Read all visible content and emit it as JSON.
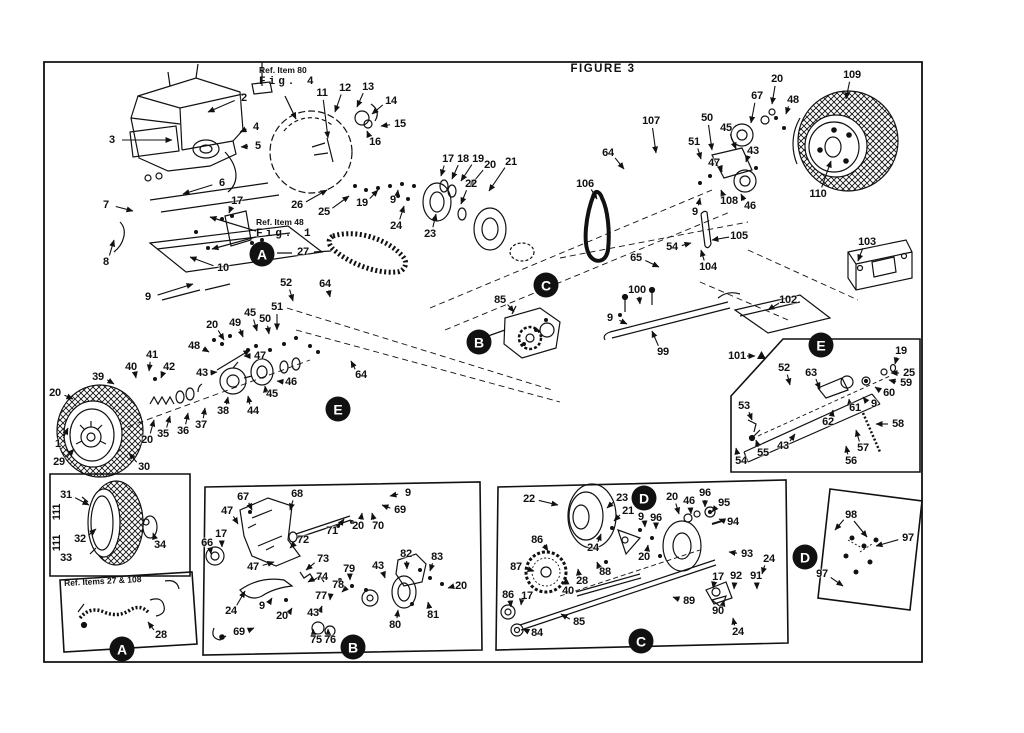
{
  "figure": {
    "title": "FIGURE 3"
  },
  "notes": {
    "top_ref": {
      "line1": "Ref. Item 80",
      "line2": "Fig. 4"
    },
    "mid_ref": {
      "line1": "Ref. Item 48",
      "line2": "Fig. 1"
    },
    "inset_a2_title": "Ref. Items 27 & 108"
  },
  "colors": {
    "ink": "#111111",
    "paper": "#ffffff"
  },
  "callouts": [
    {
      "letter": "A",
      "x": 262,
      "y": 254
    },
    {
      "letter": "A",
      "x": 122,
      "y": 649
    },
    {
      "letter": "B",
      "x": 479,
      "y": 342
    },
    {
      "letter": "B",
      "x": 353,
      "y": 647
    },
    {
      "letter": "C",
      "x": 546,
      "y": 285
    },
    {
      "letter": "C",
      "x": 641,
      "y": 641
    },
    {
      "letter": "D",
      "x": 644,
      "y": 498
    },
    {
      "letter": "D",
      "x": 805,
      "y": 557
    },
    {
      "letter": "E",
      "x": 338,
      "y": 409
    },
    {
      "letter": "E",
      "x": 821,
      "y": 345
    }
  ],
  "part_labels": [
    {
      "t": "2",
      "x": 244,
      "y": 98,
      "tx": 208,
      "ty": 112
    },
    {
      "t": "3",
      "x": 112,
      "y": 140,
      "tx": 172,
      "ty": 140
    },
    {
      "t": "4",
      "x": 256,
      "y": 127,
      "tx": 240,
      "ty": 132
    },
    {
      "t": "5",
      "x": 258,
      "y": 146,
      "tx": 241,
      "ty": 147
    },
    {
      "t": "6",
      "x": 222,
      "y": 183,
      "tx": 183,
      "ty": 194
    },
    {
      "t": "7",
      "x": 106,
      "y": 205,
      "tx": 133,
      "ty": 211
    },
    {
      "t": "8",
      "x": 106,
      "y": 262,
      "tx": 114,
      "ty": 240
    },
    {
      "t": "9",
      "x": 148,
      "y": 297,
      "tx": 193,
      "ty": 284
    },
    {
      "t": "10",
      "x": 223,
      "y": 268,
      "tx": 190,
      "ty": 257
    },
    {
      "t": "17",
      "x": 237,
      "y": 201,
      "tx": 229,
      "ty": 213
    },
    {
      "t": "27",
      "x": 303,
      "y": 252
    },
    {
      "t": "11",
      "x": 322,
      "y": 93,
      "tx": 328,
      "ty": 138
    },
    {
      "t": "12",
      "x": 345,
      "y": 88,
      "tx": 335,
      "ty": 112
    },
    {
      "t": "13",
      "x": 368,
      "y": 87,
      "tx": 357,
      "ty": 107
    },
    {
      "t": "14",
      "x": 391,
      "y": 101,
      "tx": 372,
      "ty": 114
    },
    {
      "t": "15",
      "x": 400,
      "y": 124,
      "tx": 381,
      "ty": 126
    },
    {
      "t": "16",
      "x": 375,
      "y": 142,
      "tx": 367,
      "ty": 131
    },
    {
      "t": "17",
      "x": 448,
      "y": 159,
      "tx": 441,
      "ty": 176
    },
    {
      "t": "18",
      "x": 463,
      "y": 159,
      "tx": 452,
      "ty": 179
    },
    {
      "t": "19",
      "x": 478,
      "y": 159,
      "tx": 461,
      "ty": 181
    },
    {
      "t": "20",
      "x": 490,
      "y": 165,
      "tx": 470,
      "ty": 186
    },
    {
      "t": "21",
      "x": 511,
      "y": 162,
      "tx": 489,
      "ty": 191
    },
    {
      "t": "22",
      "x": 471,
      "y": 184,
      "tx": 461,
      "ty": 204
    },
    {
      "t": "23",
      "x": 430,
      "y": 234,
      "tx": 436,
      "ty": 214
    },
    {
      "t": "24",
      "x": 396,
      "y": 226,
      "tx": 404,
      "ty": 206
    },
    {
      "t": "9",
      "x": 393,
      "y": 200,
      "tx": 398,
      "ty": 190
    },
    {
      "t": "19",
      "x": 362,
      "y": 203,
      "tx": 378,
      "ty": 190
    },
    {
      "t": "25",
      "x": 324,
      "y": 212,
      "tx": 349,
      "ty": 196
    },
    {
      "t": "26",
      "x": 297,
      "y": 205,
      "tx": 327,
      "ty": 190
    },
    {
      "t": "52",
      "x": 286,
      "y": 283,
      "tx": 293,
      "ty": 301
    },
    {
      "t": "64",
      "x": 325,
      "y": 284,
      "tx": 330,
      "ty": 297
    },
    {
      "t": "51",
      "x": 277,
      "y": 307,
      "tx": 277,
      "ty": 330
    },
    {
      "t": "50",
      "x": 265,
      "y": 319,
      "tx": 269,
      "ty": 334
    },
    {
      "t": "45",
      "x": 250,
      "y": 313,
      "tx": 257,
      "ty": 331
    },
    {
      "t": "49",
      "x": 235,
      "y": 323,
      "tx": 243,
      "ty": 337
    },
    {
      "t": "20",
      "x": 212,
      "y": 325,
      "tx": 224,
      "ty": 340
    },
    {
      "t": "48",
      "x": 194,
      "y": 346,
      "tx": 209,
      "ty": 352
    },
    {
      "t": "47",
      "x": 260,
      "y": 356,
      "tx": 244,
      "ty": 356
    },
    {
      "t": "43",
      "x": 202,
      "y": 373,
      "tx": 217,
      "ty": 372
    },
    {
      "t": "41",
      "x": 152,
      "y": 355,
      "tx": 149,
      "ty": 371
    },
    {
      "t": "40",
      "x": 131,
      "y": 367,
      "tx": 136,
      "ty": 378
    },
    {
      "t": "39",
      "x": 98,
      "y": 377,
      "tx": 114,
      "ty": 384
    },
    {
      "t": "42",
      "x": 169,
      "y": 367,
      "tx": 161,
      "ty": 378
    },
    {
      "t": "20",
      "x": 55,
      "y": 393,
      "tx": 73,
      "ty": 399
    },
    {
      "t": "46",
      "x": 291,
      "y": 382,
      "tx": 277,
      "ty": 381
    },
    {
      "t": "45",
      "x": 272,
      "y": 394,
      "tx": 265,
      "ty": 386
    },
    {
      "t": "44",
      "x": 253,
      "y": 411,
      "tx": 248,
      "ty": 396
    },
    {
      "t": "38",
      "x": 223,
      "y": 411,
      "tx": 228,
      "ty": 397
    },
    {
      "t": "37",
      "x": 201,
      "y": 425,
      "tx": 205,
      "ty": 408
    },
    {
      "t": "36",
      "x": 183,
      "y": 431,
      "tx": 188,
      "ty": 413
    },
    {
      "t": "35",
      "x": 163,
      "y": 434,
      "tx": 170,
      "ty": 416
    },
    {
      "t": "20",
      "x": 147,
      "y": 440,
      "tx": 154,
      "ty": 420
    },
    {
      "t": "1",
      "x": 58,
      "y": 444,
      "tx": 68,
      "ty": 428
    },
    {
      "t": "29",
      "x": 59,
      "y": 462,
      "tx": 74,
      "ty": 449
    },
    {
      "t": "30",
      "x": 144,
      "y": 467,
      "tx": 129,
      "ty": 453
    },
    {
      "t": "64",
      "x": 361,
      "y": 375,
      "tx": 351,
      "ty": 361
    },
    {
      "t": "85",
      "x": 500,
      "y": 300,
      "tx": 514,
      "ty": 312
    },
    {
      "t": "65",
      "x": 636,
      "y": 258,
      "tx": 659,
      "ty": 267
    },
    {
      "t": "100",
      "x": 637,
      "y": 290,
      "tx": 640,
      "ty": 304
    },
    {
      "t": "9",
      "x": 610,
      "y": 318,
      "tx": 627,
      "ty": 324
    },
    {
      "t": "99",
      "x": 663,
      "y": 352,
      "tx": 652,
      "ty": 331
    },
    {
      "t": "106",
      "x": 585,
      "y": 184,
      "tx": 597,
      "ty": 199
    },
    {
      "t": "64",
      "x": 608,
      "y": 153,
      "tx": 624,
      "ty": 169
    },
    {
      "t": "107",
      "x": 651,
      "y": 121,
      "tx": 656,
      "ty": 153
    },
    {
      "t": "50",
      "x": 707,
      "y": 118,
      "tx": 712,
      "ty": 150
    },
    {
      "t": "51",
      "x": 694,
      "y": 142,
      "tx": 701,
      "ty": 159
    },
    {
      "t": "67",
      "x": 757,
      "y": 96,
      "tx": 751,
      "ty": 123
    },
    {
      "t": "20",
      "x": 777,
      "y": 79,
      "tx": 772,
      "ty": 104
    },
    {
      "t": "48",
      "x": 793,
      "y": 100,
      "tx": 786,
      "ty": 114
    },
    {
      "t": "45",
      "x": 726,
      "y": 128,
      "tx": 736,
      "ty": 149
    },
    {
      "t": "43",
      "x": 753,
      "y": 151,
      "tx": 746,
      "ty": 162
    },
    {
      "t": "47",
      "x": 714,
      "y": 163,
      "tx": 722,
      "ty": 172
    },
    {
      "t": "46",
      "x": 750,
      "y": 206,
      "tx": 741,
      "ty": 194
    },
    {
      "t": "108",
      "x": 729,
      "y": 201,
      "tx": 721,
      "ty": 190
    },
    {
      "t": "9",
      "x": 695,
      "y": 212,
      "tx": 700,
      "ty": 198
    },
    {
      "t": "105",
      "x": 739,
      "y": 236,
      "tx": 712,
      "ty": 240
    },
    {
      "t": "54",
      "x": 672,
      "y": 247,
      "tx": 691,
      "ty": 243
    },
    {
      "t": "104",
      "x": 708,
      "y": 267,
      "tx": 701,
      "ty": 250
    },
    {
      "t": "109",
      "x": 852,
      "y": 75,
      "tx": 846,
      "ty": 99
    },
    {
      "t": "110",
      "x": 818,
      "y": 194,
      "tx": 831,
      "ty": 161
    },
    {
      "t": "103",
      "x": 867,
      "y": 242,
      "tx": 858,
      "ty": 261
    },
    {
      "t": "102",
      "x": 788,
      "y": 300,
      "tx": 768,
      "ty": 310
    },
    {
      "t": "101",
      "x": 737,
      "y": 356,
      "tx": 755,
      "ty": 356
    },
    {
      "t": "52",
      "x": 784,
      "y": 368,
      "tx": 790,
      "ty": 385
    },
    {
      "t": "63",
      "x": 811,
      "y": 373,
      "tx": 820,
      "ty": 389
    },
    {
      "t": "19",
      "x": 901,
      "y": 351,
      "tx": 895,
      "ty": 364
    },
    {
      "t": "25",
      "x": 909,
      "y": 373,
      "tx": 891,
      "ty": 373
    },
    {
      "t": "59",
      "x": 906,
      "y": 383,
      "tx": 889,
      "ty": 380
    },
    {
      "t": "60",
      "x": 889,
      "y": 393,
      "tx": 875,
      "ty": 387
    },
    {
      "t": "9",
      "x": 874,
      "y": 404,
      "tx": 863,
      "ty": 397
    },
    {
      "t": "61",
      "x": 855,
      "y": 408,
      "tx": 849,
      "ty": 399
    },
    {
      "t": "62",
      "x": 828,
      "y": 422,
      "tx": 833,
      "ty": 410
    },
    {
      "t": "53",
      "x": 744,
      "y": 406,
      "tx": 752,
      "ty": 420
    },
    {
      "t": "55",
      "x": 763,
      "y": 453,
      "tx": 756,
      "ty": 440
    },
    {
      "t": "54",
      "x": 741,
      "y": 461,
      "tx": 736,
      "ty": 448
    },
    {
      "t": "43",
      "x": 783,
      "y": 446,
      "tx": 795,
      "ty": 434
    },
    {
      "t": "57",
      "x": 863,
      "y": 448,
      "tx": 856,
      "ty": 430
    },
    {
      "t": "56",
      "x": 851,
      "y": 461,
      "tx": 846,
      "ty": 446
    },
    {
      "t": "58",
      "x": 898,
      "y": 424,
      "tx": 876,
      "ty": 424
    },
    {
      "t": "31",
      "x": 66,
      "y": 495,
      "tx": 89,
      "ty": 505
    },
    {
      "t": "32",
      "x": 80,
      "y": 539,
      "tx": 96,
      "ty": 529
    },
    {
      "t": "33",
      "x": 66,
      "y": 558
    },
    {
      "t": "111",
      "x": 57,
      "y": 512,
      "rot": -90
    },
    {
      "t": "111",
      "x": 57,
      "y": 543,
      "rot": -90
    },
    {
      "t": "34",
      "x": 160,
      "y": 545,
      "tx": 153,
      "ty": 533
    },
    {
      "t": "28",
      "x": 161,
      "y": 635,
      "tx": 148,
      "ty": 622
    },
    {
      "t": "67",
      "x": 243,
      "y": 497,
      "tx": 252,
      "ty": 510
    },
    {
      "t": "68",
      "x": 297,
      "y": 494,
      "tx": 290,
      "ty": 510
    },
    {
      "t": "9",
      "x": 408,
      "y": 493,
      "tx": 390,
      "ty": 496
    },
    {
      "t": "69",
      "x": 400,
      "y": 510,
      "tx": 382,
      "ty": 505
    },
    {
      "t": "20",
      "x": 358,
      "y": 526,
      "tx": 362,
      "ty": 513
    },
    {
      "t": "70",
      "x": 378,
      "y": 526,
      "tx": 372,
      "ty": 513
    },
    {
      "t": "71",
      "x": 332,
      "y": 531,
      "tx": 344,
      "ty": 519
    },
    {
      "t": "47",
      "x": 227,
      "y": 511,
      "tx": 238,
      "ty": 524
    },
    {
      "t": "17",
      "x": 221,
      "y": 534,
      "tx": 222,
      "ty": 547
    },
    {
      "t": "66",
      "x": 207,
      "y": 543,
      "tx": 211,
      "ty": 554
    },
    {
      "t": "72",
      "x": 303,
      "y": 540,
      "tx": 290,
      "ty": 548
    },
    {
      "t": "47",
      "x": 253,
      "y": 567,
      "tx": 274,
      "ty": 562
    },
    {
      "t": "73",
      "x": 323,
      "y": 559,
      "tx": 306,
      "ty": 570
    },
    {
      "t": "74",
      "x": 322,
      "y": 577,
      "tx": 308,
      "ty": 582
    },
    {
      "t": "24",
      "x": 231,
      "y": 611,
      "tx": 245,
      "ty": 591
    },
    {
      "t": "9",
      "x": 262,
      "y": 606,
      "tx": 272,
      "ty": 598
    },
    {
      "t": "20",
      "x": 282,
      "y": 616,
      "tx": 292,
      "ty": 608
    },
    {
      "t": "43",
      "x": 313,
      "y": 613,
      "tx": 322,
      "ty": 606
    },
    {
      "t": "77",
      "x": 321,
      "y": 596,
      "tx": 330,
      "ty": 600
    },
    {
      "t": "78",
      "x": 338,
      "y": 585,
      "tx": 342,
      "ty": 592
    },
    {
      "t": "79",
      "x": 349,
      "y": 569,
      "tx": 350,
      "ty": 580
    },
    {
      "t": "75",
      "x": 316,
      "y": 640,
      "tx": 313,
      "ty": 629
    },
    {
      "t": "76",
      "x": 330,
      "y": 640,
      "tx": 328,
      "ty": 629
    },
    {
      "t": "69",
      "x": 239,
      "y": 632,
      "tx": 254,
      "ty": 628
    },
    {
      "t": "82",
      "x": 406,
      "y": 554,
      "tx": 407,
      "ty": 569
    },
    {
      "t": "83",
      "x": 437,
      "y": 557,
      "tx": 430,
      "ty": 571
    },
    {
      "t": "43",
      "x": 378,
      "y": 566,
      "tx": 385,
      "ty": 578
    },
    {
      "t": "20",
      "x": 461,
      "y": 586,
      "tx": 448,
      "ty": 588
    },
    {
      "t": "81",
      "x": 433,
      "y": 615,
      "tx": 428,
      "ty": 602
    },
    {
      "t": "80",
      "x": 395,
      "y": 625,
      "tx": 398,
      "ty": 610
    },
    {
      "t": "22",
      "x": 529,
      "y": 499,
      "tx": 558,
      "ty": 505
    },
    {
      "t": "23",
      "x": 622,
      "y": 498,
      "tx": 607,
      "ty": 508
    },
    {
      "t": "21",
      "x": 628,
      "y": 511,
      "tx": 614,
      "ty": 521
    },
    {
      "t": "24",
      "x": 593,
      "y": 548,
      "tx": 601,
      "ty": 534
    },
    {
      "t": "20",
      "x": 672,
      "y": 497,
      "tx": 679,
      "ty": 514
    },
    {
      "t": "46",
      "x": 689,
      "y": 501,
      "tx": 691,
      "ty": 514
    },
    {
      "t": "96",
      "x": 705,
      "y": 493,
      "tx": 705,
      "ty": 507
    },
    {
      "t": "95",
      "x": 724,
      "y": 503,
      "tx": 712,
      "ty": 512
    },
    {
      "t": "94",
      "x": 733,
      "y": 522,
      "tx": 719,
      "ty": 519
    },
    {
      "t": "9",
      "x": 641,
      "y": 517,
      "tx": 645,
      "ty": 527
    },
    {
      "t": "96",
      "x": 656,
      "y": 518,
      "tx": 656,
      "ty": 529
    },
    {
      "t": "20",
      "x": 644,
      "y": 557,
      "tx": 648,
      "ty": 545
    },
    {
      "t": "86",
      "x": 537,
      "y": 540,
      "tx": 548,
      "ty": 551
    },
    {
      "t": "87",
      "x": 516,
      "y": 567,
      "tx": 534,
      "ty": 571
    },
    {
      "t": "88",
      "x": 605,
      "y": 572,
      "tx": 597,
      "ty": 562
    },
    {
      "t": "28",
      "x": 582,
      "y": 581,
      "tx": 578,
      "ty": 569
    },
    {
      "t": "40",
      "x": 568,
      "y": 591,
      "tx": 566,
      "ty": 578
    },
    {
      "t": "17",
      "x": 527,
      "y": 596,
      "tx": 521,
      "ty": 605
    },
    {
      "t": "86",
      "x": 508,
      "y": 595,
      "tx": 511,
      "ty": 607
    },
    {
      "t": "84",
      "x": 537,
      "y": 633,
      "tx": 523,
      "ty": 629
    },
    {
      "t": "85",
      "x": 579,
      "y": 622,
      "tx": 561,
      "ty": 614
    },
    {
      "t": "89",
      "x": 689,
      "y": 601,
      "tx": 673,
      "ty": 597
    },
    {
      "t": "93",
      "x": 747,
      "y": 554,
      "tx": 729,
      "ty": 552
    },
    {
      "t": "24",
      "x": 769,
      "y": 559,
      "tx": 762,
      "ty": 574
    },
    {
      "t": "91",
      "x": 756,
      "y": 576,
      "tx": 757,
      "ty": 589
    },
    {
      "t": "92",
      "x": 736,
      "y": 576,
      "tx": 734,
      "ty": 589
    },
    {
      "t": "17",
      "x": 718,
      "y": 577,
      "tx": 713,
      "ty": 588
    },
    {
      "t": "90",
      "x": 718,
      "y": 611,
      "tx": 724,
      "ty": 600
    },
    {
      "t": "24",
      "x": 738,
      "y": 632,
      "tx": 733,
      "ty": 618
    },
    {
      "t": "98",
      "x": 851,
      "y": 515,
      "tx": 835,
      "ty": 530
    },
    {
      "t": "97",
      "x": 908,
      "y": 538,
      "tx": 876,
      "ty": 546
    },
    {
      "t": "97",
      "x": 822,
      "y": 574,
      "tx": 843,
      "ty": 586
    }
  ]
}
